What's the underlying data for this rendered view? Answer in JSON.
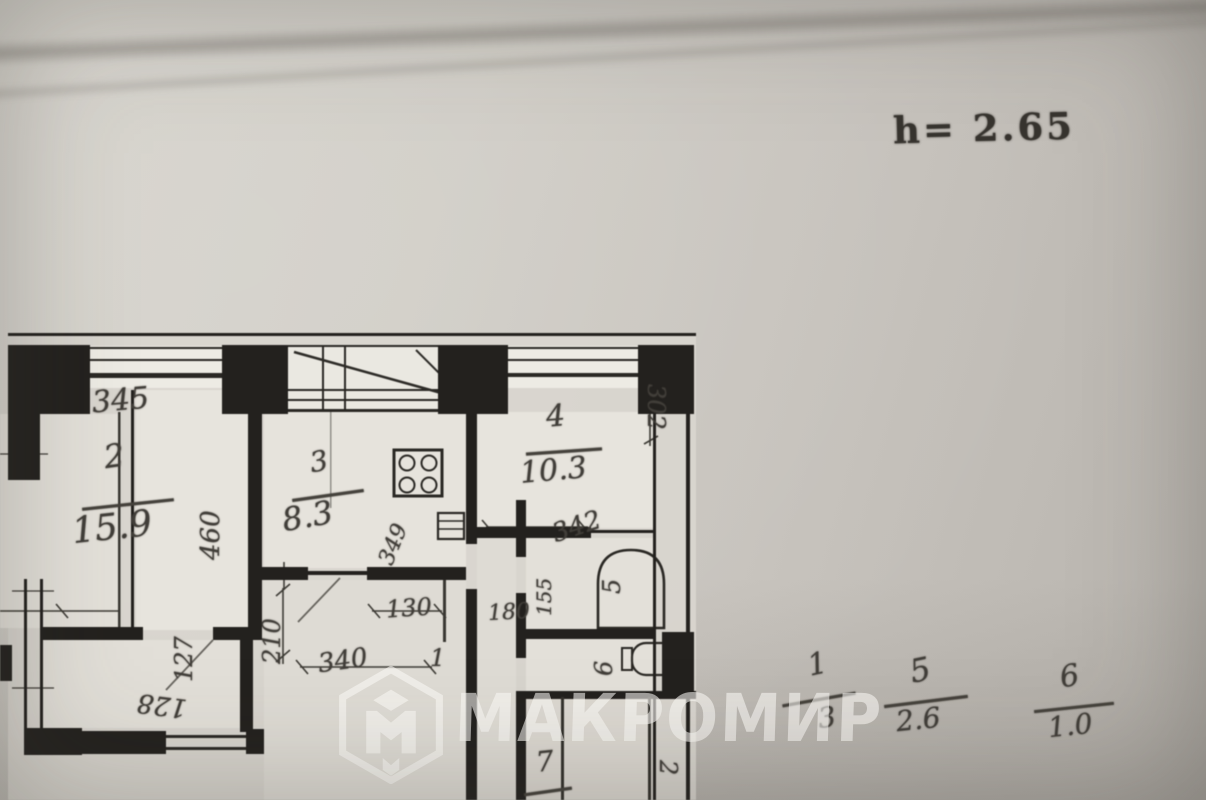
{
  "ceiling_note": "h= 2.65",
  "watermark": {
    "text": "МАКРОМИР",
    "logo": "makromir-hex-cube-logo"
  },
  "plan": {
    "room_labels": [
      {
        "number": "2",
        "area": "15.9"
      },
      {
        "number": "3",
        "area": "8.3"
      },
      {
        "number": "4",
        "area": "10.3"
      },
      {
        "number": "5"
      },
      {
        "number": "6"
      },
      {
        "number": "7"
      }
    ],
    "dimensions": {
      "top_345": "345",
      "right_460": "460",
      "kitchen_349": "349",
      "room4_302": "302",
      "room4_342": "342",
      "hall_210": "210",
      "hall_130": "130",
      "hall_340": "340",
      "hall_180": "180",
      "bath_155": "155",
      "lower_127": "127",
      "lower_128": "128",
      "door_1": "1",
      "bottom_2": "2"
    }
  },
  "area_fractions": [
    {
      "number": "1",
      "area": "3"
    },
    {
      "number": "5",
      "area": "2.6"
    },
    {
      "number": "6",
      "area": "1.0"
    }
  ]
}
